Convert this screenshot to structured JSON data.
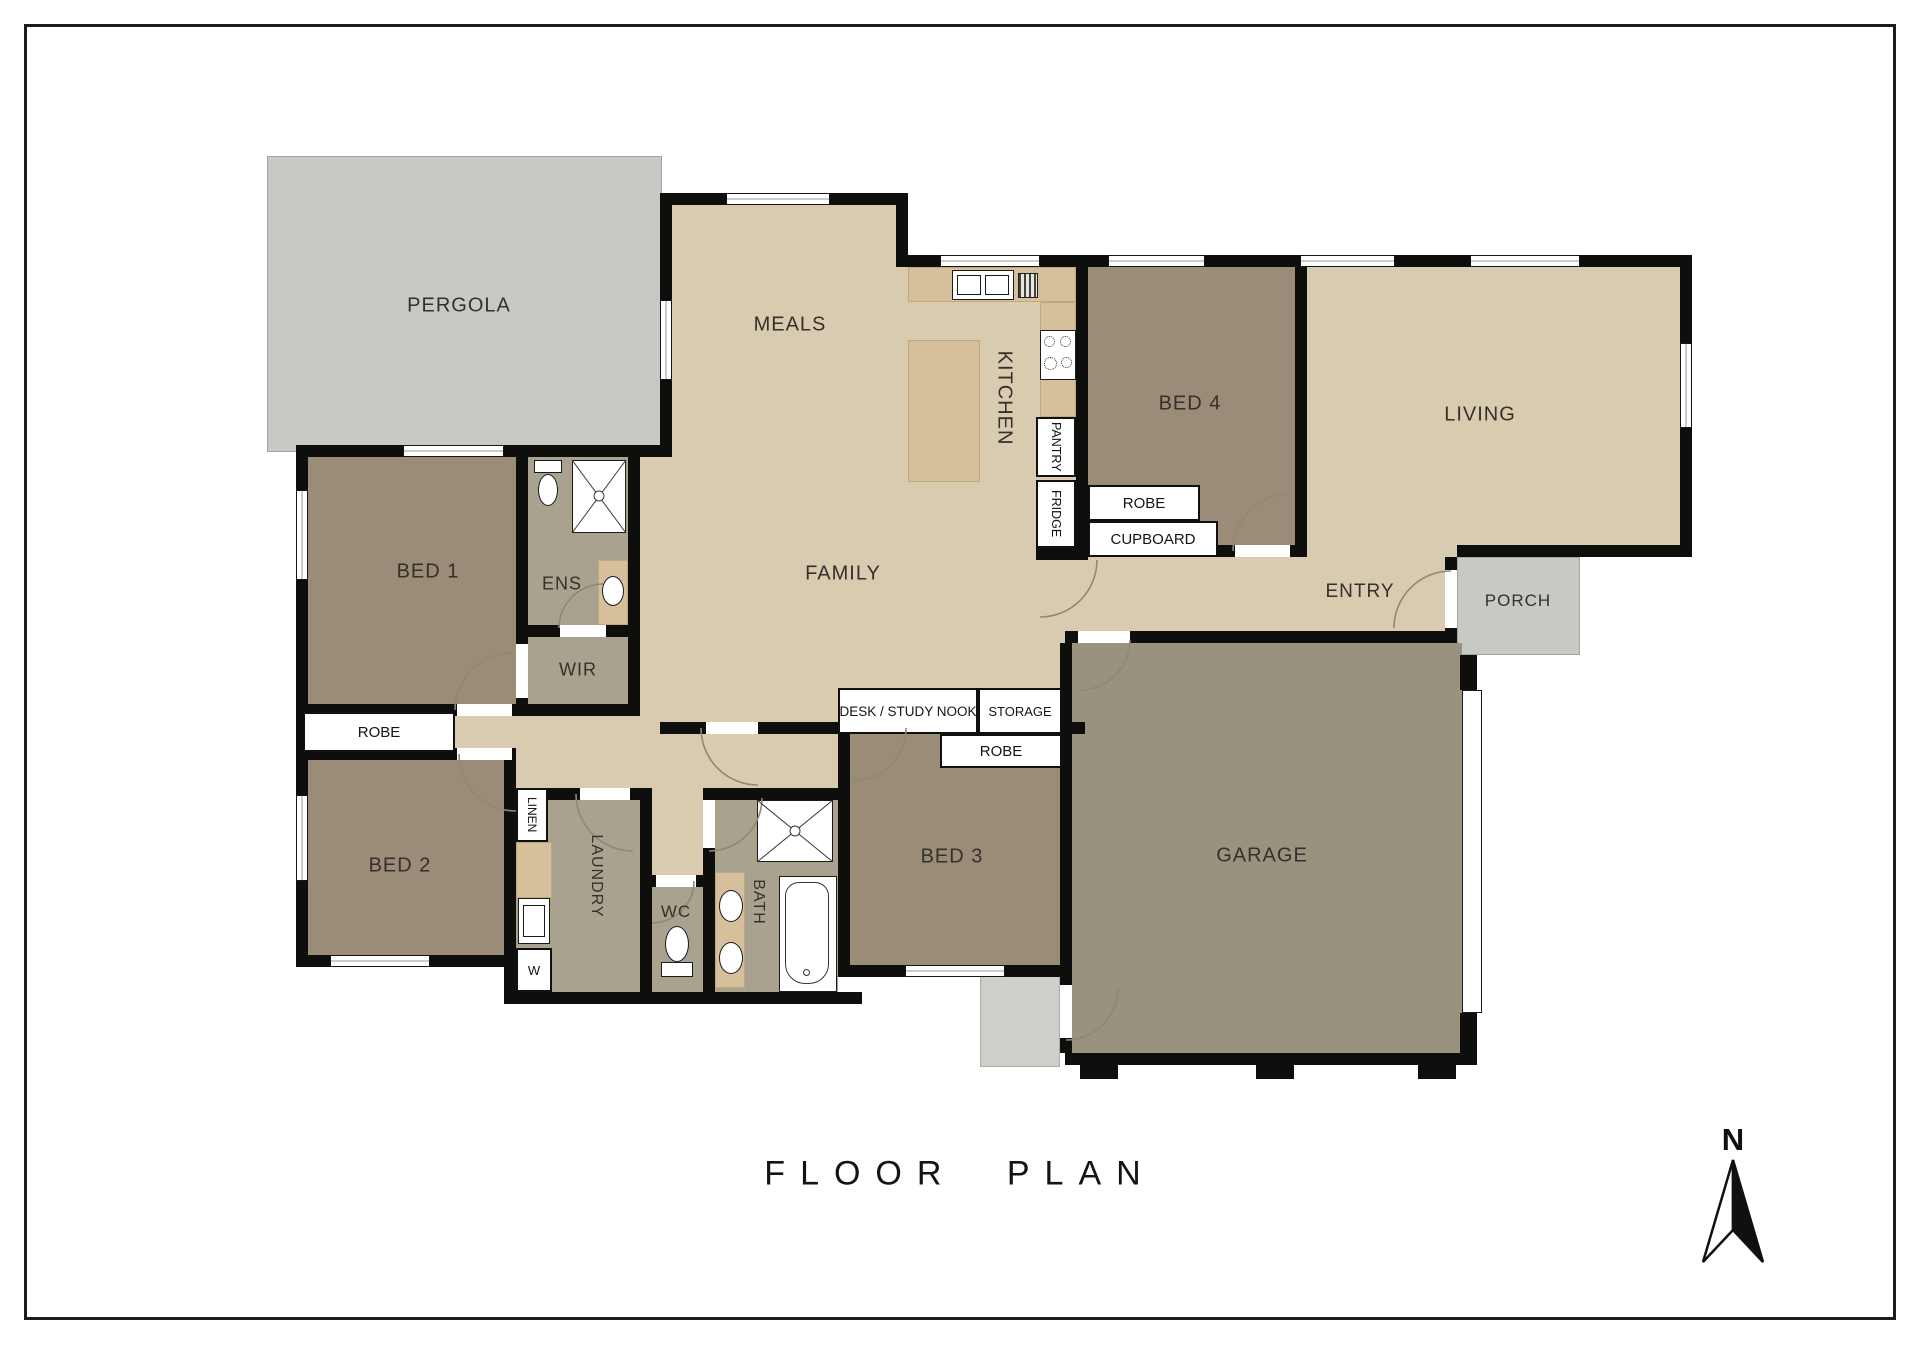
{
  "page": {
    "title": "FLOOR PLAN",
    "compass_label": "N"
  },
  "rooms": {
    "pergola": "PERGOLA",
    "meals": "MEALS",
    "kitchen": "KITCHEN",
    "bed4": "BED 4",
    "living": "LIVING",
    "entry": "ENTRY",
    "porch": "PORCH",
    "family": "FAMILY",
    "bed1": "BED 1",
    "ens": "ENS",
    "wir": "WIR",
    "bed2": "BED 2",
    "bed3": "BED 3",
    "laundry": "LAUNDRY",
    "wc": "WC",
    "bath": "BATH",
    "garage": "GARAGE"
  },
  "storage": {
    "robe_bed1": "ROBE",
    "robe_bed4": "ROBE",
    "robe_bed3": "ROBE",
    "cupboard": "CUPBOARD",
    "pantry": "PANTRY",
    "fridge": "FRIDGE",
    "linen": "LINEN",
    "washer": "W",
    "desk": "DESK / STUDY NOOK",
    "storage": "STORAGE"
  },
  "colors": {
    "wall": "#0e0e0d",
    "floor_main": "#d9cbb0",
    "floor_bedroom": "#9a8c77",
    "floor_wet_area": "#a9a28e",
    "floor_garage": "#98927f",
    "outdoor_gray": "#c7c9c4",
    "counter": "#d6c09b"
  }
}
